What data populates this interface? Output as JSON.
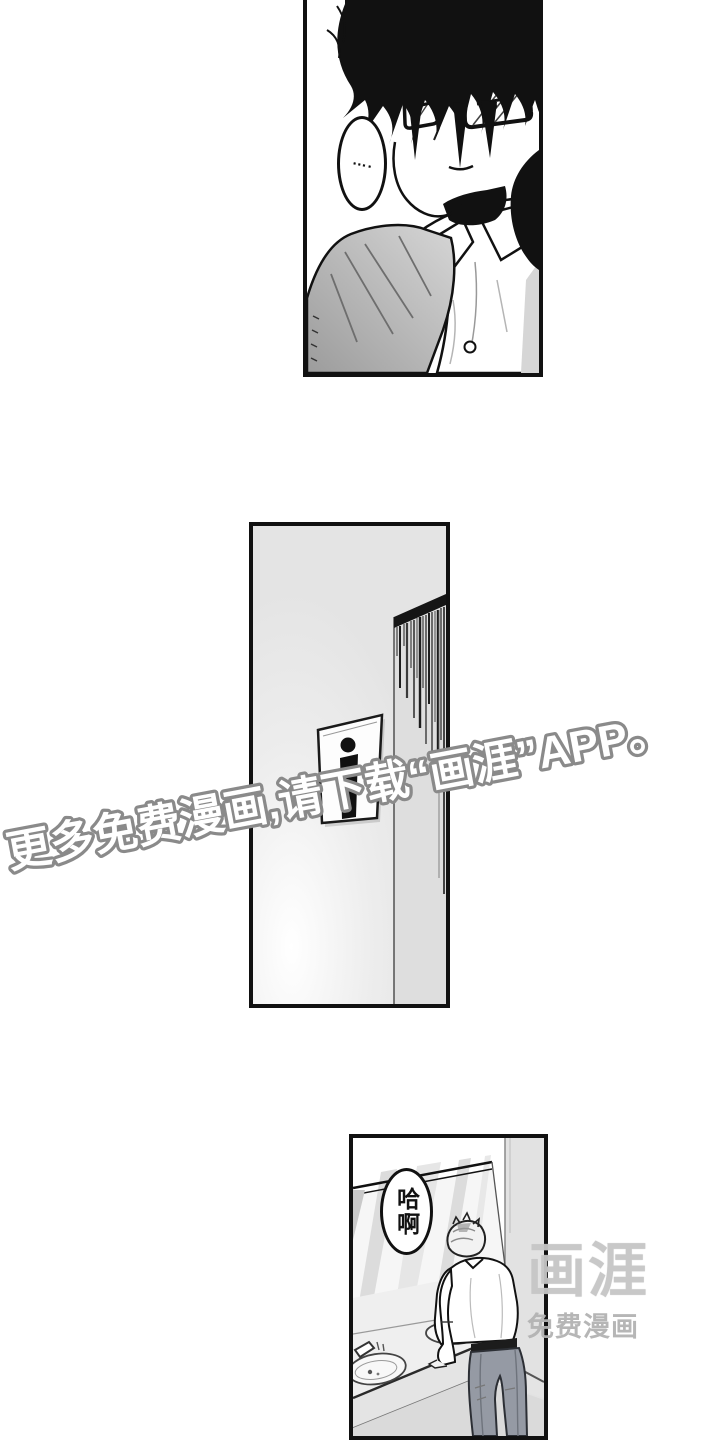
{
  "page": {
    "background": "#ffffff",
    "panel_border_color": "#111111"
  },
  "panels": {
    "top": {
      "speech_bubble": "…."
    },
    "middle": {},
    "bottom": {
      "speech_bubble": "哈啊"
    }
  },
  "watermark": {
    "diagonal_text": "更多免费漫画,请下载“画涯”APP。",
    "fill_color": "#ffffff",
    "outline_color": "#8a8a8a"
  },
  "logo": {
    "title": "画涯",
    "subtitle": "免费漫画",
    "title_color": "#c6c6c6",
    "subtitle_color": "#b3b3b3"
  }
}
